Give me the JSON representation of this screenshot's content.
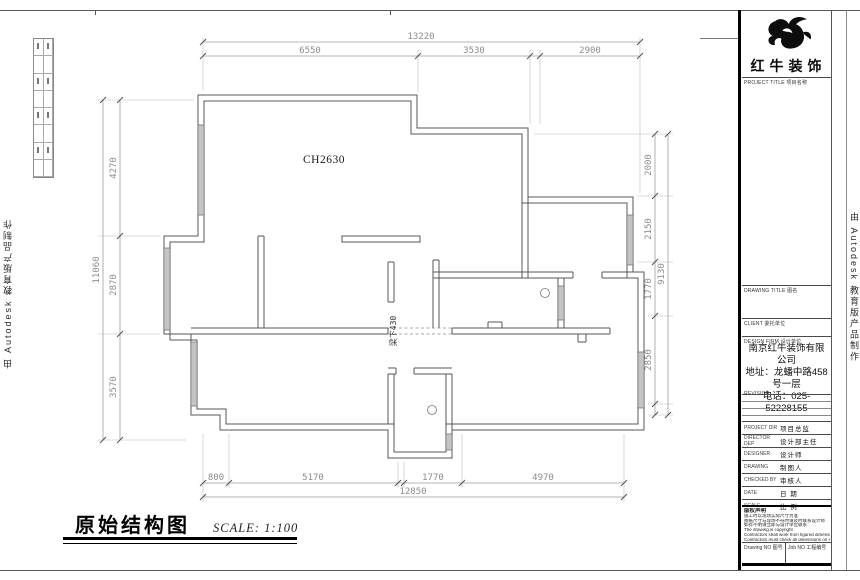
{
  "sheet": {
    "watermark_left": "由 Autodesk 教育版产品制作",
    "watermark_right": "由 Autodesk 教育版产品制作",
    "footer": {
      "drawing_title": "原始结构图",
      "scale_note": "SCALE: 1:100"
    }
  },
  "plan": {
    "labels": {
      "ceiling_height": "CH2630",
      "beam_note": "梁下430"
    },
    "dims": {
      "top": {
        "overall": "13220",
        "segs": [
          "6550",
          "3530",
          "2900"
        ]
      },
      "bottom": {
        "overall": "12850",
        "segs": [
          "800",
          "5170",
          "1770",
          "4970"
        ]
      },
      "left": {
        "overall": "11060",
        "segs": [
          "4270",
          "2870",
          "3570"
        ]
      },
      "right": {
        "overall": "9130",
        "segs": [
          "2000",
          "2150",
          "1770",
          "2850"
        ]
      }
    }
  },
  "title_block": {
    "brand": {
      "name": "红牛装饰",
      "logo": "bull-logo"
    },
    "labels": {
      "project_title": "PROJECT TITLE 项目名称",
      "drawing_title": "DRAWING TITLE 图名",
      "client": "CLIENT 委托单位",
      "design_firm": "DESIGN FIRM 设计单位",
      "revision": "REVISION"
    },
    "company": {
      "name": "南京红牛装饰有限公司",
      "address": "地址：龙蟠中路458号一层",
      "phone": "电话：025-52228155"
    },
    "fields": [
      {
        "en": "PROJECT DIR",
        "cn": "项目总监"
      },
      {
        "en": "DIRECTOR DEP",
        "cn": "设计部主任"
      },
      {
        "en": "DESIGNER",
        "cn": "设计师"
      },
      {
        "en": "DRAWING",
        "cn": "制图人"
      },
      {
        "en": "CHECKED BY",
        "cn": "审核人"
      },
      {
        "en": "DATE",
        "cn": "日 期"
      },
      {
        "en": "SCALE",
        "cn": "比 例"
      }
    ],
    "notes": {
      "header": "版权声明",
      "lines": [
        "施工时以现场实际尺寸为准",
        "图纸尺寸与现场不符时请及时联系设计师",
        "如有不明请立即与设计单位联系",
        "The drawing is copyright",
        "Contractors shall work from figured dimensions only",
        "Contractors must check all dimensions on site",
        "Discrepancies must be reported immediately to architects"
      ]
    },
    "footer_cells": [
      {
        "label": "Drawing NO 图号"
      },
      {
        "label": "Job NO 工程编号"
      }
    ]
  }
}
